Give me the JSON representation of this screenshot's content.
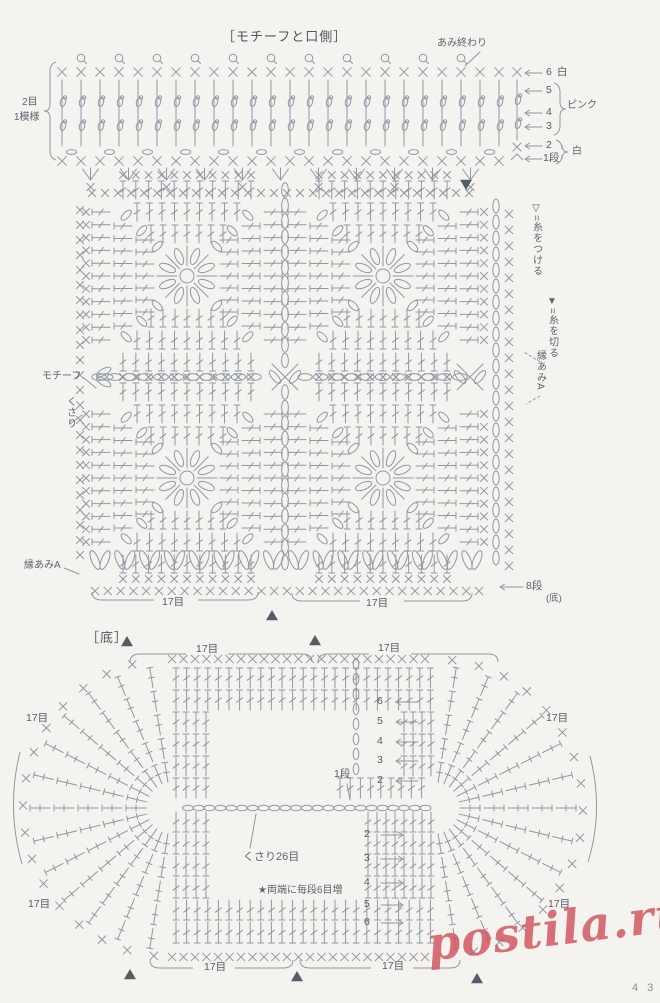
{
  "page": {
    "background": "#f4f3ef",
    "ink": "#8f98a3",
    "text_color": "#5d646d",
    "watermark": "postila.ru",
    "watermark_color": "#d05760",
    "page_number": "4 3"
  },
  "top_section": {
    "title": "［モチーフと口側］",
    "finish_label": "あみ終わり",
    "repeat_line1": "2目",
    "repeat_line2": "1模様",
    "row_numbers": [
      {
        "label": "6",
        "color_note": "白"
      },
      {
        "label": "5",
        "color_note": ""
      },
      {
        "label": "4",
        "color_note": "ピンク"
      },
      {
        "label": "3",
        "color_note": ""
      },
      {
        "label": "2",
        "color_note": ""
      },
      {
        "label": "1段",
        "color_note": "白"
      }
    ],
    "legend_attach": "▽=糸をつける",
    "legend_cut": "▼=糸を切る",
    "motif_label": "モチーフ",
    "chain_label": "くさり",
    "edge_right_label": "縁あみA",
    "edge_left_label": "縁あみA",
    "row8_label": "8段",
    "row8_sub": "(底)",
    "stitch_count_left": "17目",
    "stitch_count_right": "17目"
  },
  "bottom_section": {
    "title": "［底］",
    "stitch_count_top_left": "17目",
    "stitch_count_top_right": "17目",
    "stitch_count_side_left_upper": "17目",
    "stitch_count_side_left_lower": "17目",
    "stitch_count_side_right_upper": "17目",
    "stitch_count_side_right_lower": "17目",
    "stitch_count_bottom_left": "17目",
    "stitch_count_bottom_right": "17目",
    "upper_row_numbers": [
      "6",
      "5",
      "4",
      "3",
      "2"
    ],
    "first_row_label": "1段",
    "lower_row_numbers": [
      "2",
      "3",
      "4",
      "5",
      "6"
    ],
    "foundation_label": "くさり26目",
    "increase_note": "★両端に毎段6目増"
  },
  "diagram": {
    "ink": "#8f98a3",
    "paper": "#f4f3ef",
    "opening_rows": 6,
    "motif_grid": "2×2",
    "edge_rounds_bottom": 8,
    "foundation_chains": 26,
    "increase_per_round": 6
  }
}
